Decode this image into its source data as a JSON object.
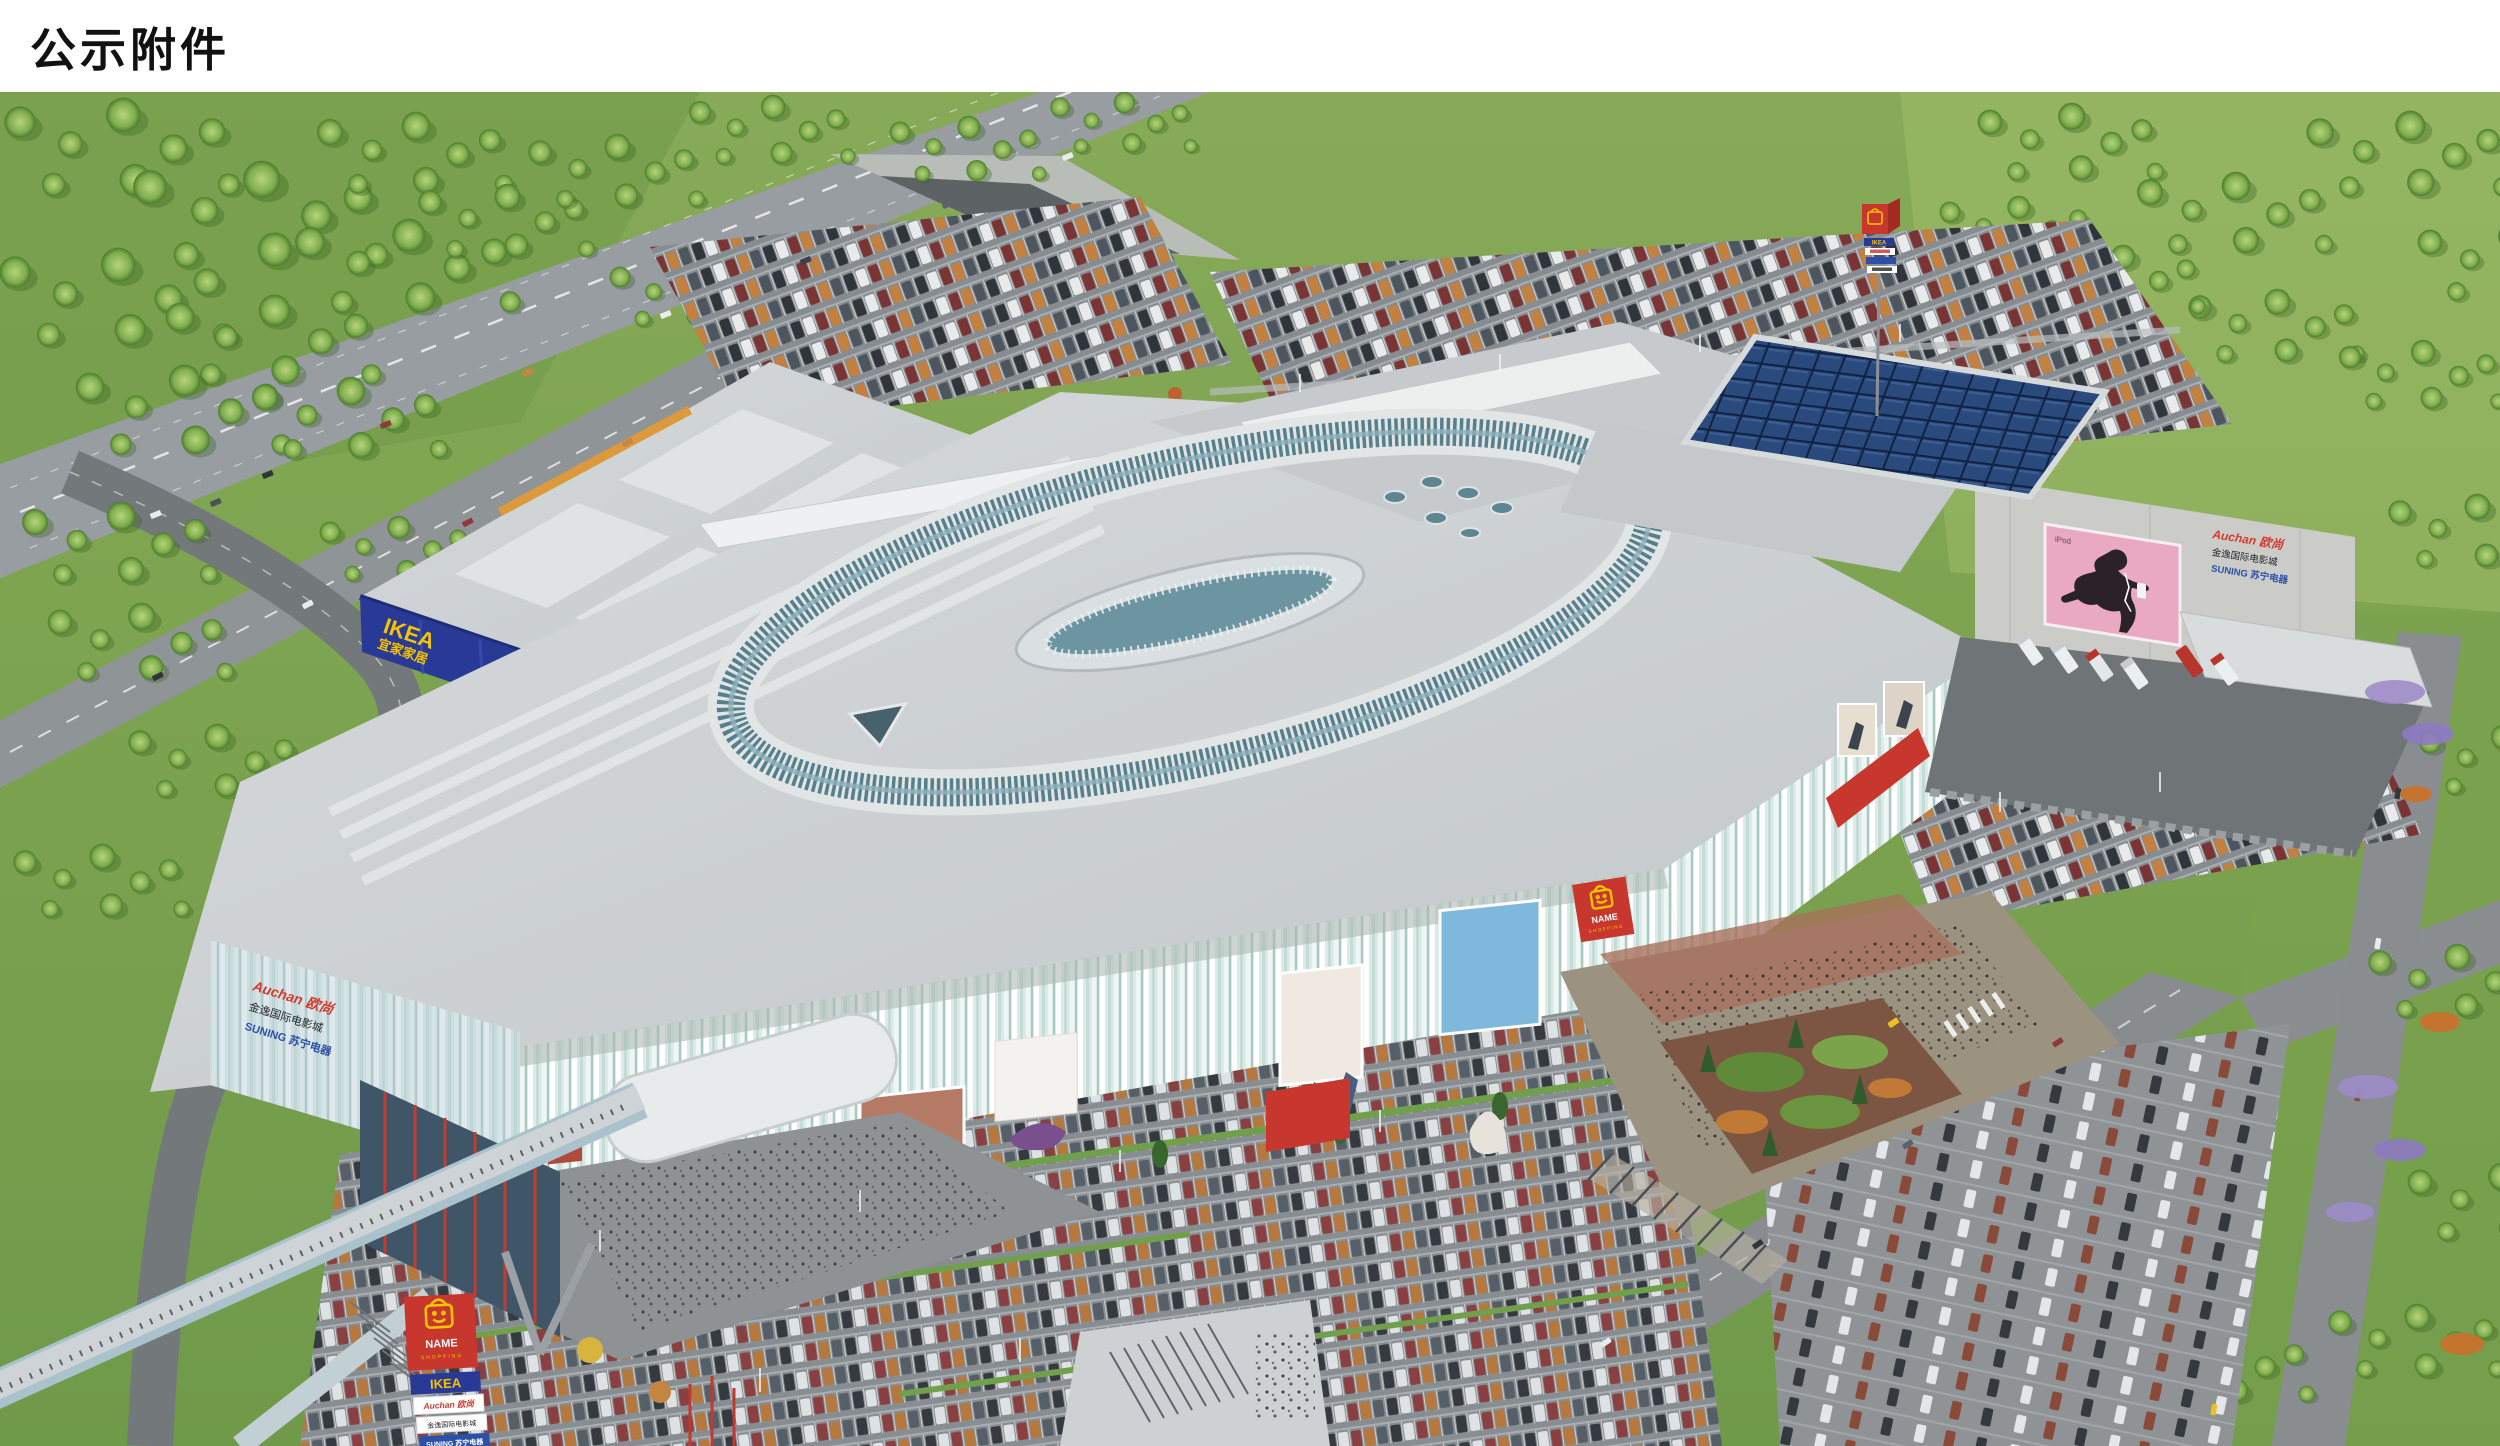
{
  "page": {
    "title": "公示附件"
  },
  "render_alt": "Aerial architectural rendering of a shopping mall complex with IKEA store, Auchan hypermarket box, oval louvered roof ring, full parking lots, highways, woodland and entrance plazas",
  "signs": {
    "ikea": "IKEA",
    "ikea_cn": "宜家家居",
    "mall_name": "NAME",
    "mall_sub": "SHOPPING",
    "auchan": "Auchan 欧尚",
    "cinema": "金逸国际电影城",
    "suning": "SUNING 苏宁电器",
    "ipod": "iPod"
  },
  "palette": {
    "header_bg": "#ffffff",
    "title_color": "#111111",
    "ikea_blue": "#283a96",
    "ikea_yellow": "#f5c400",
    "auchan_red": "#d63a2f",
    "cinema_dark": "#23252e",
    "suning_blue": "#2b50a8",
    "mall_mint": "#dcebe7",
    "louver_teal": "#57808d",
    "accent_red": "#c8372d",
    "billboard_pink": "#e9a9c1",
    "grass_green": "#7ba64e",
    "asphalt_gray": "#8f9497",
    "roof_gray": "#ccd0d2",
    "solar_blue": "#2a4a7d"
  }
}
